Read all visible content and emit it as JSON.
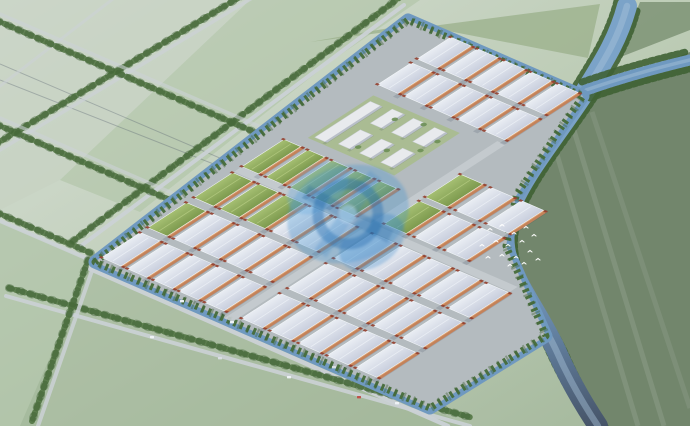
{
  "scene": {
    "canvas": {
      "width": 690,
      "height": 426
    },
    "palette": {
      "haze_white": "#f4f8fa",
      "field_pale": "#ccd6c8",
      "field_mid": "#a8bca0",
      "field_dark": "#72866c",
      "water": "#6f99c0",
      "water_dark": "#465468",
      "trees": "#4f7340",
      "trees_dark": "#3f6234",
      "road": "#ccd2d6",
      "park_ground": "#b4bbbf",
      "roof_light": "#d7dbe7",
      "roof_green": "#8fae5a",
      "wall_orange": "#c4825a",
      "wall_highlight": "#dfa777",
      "tower_red": "#94402f",
      "campus_white": "#e8eaed",
      "lawn": "#a9bd8e",
      "watermark_blue": "#3b8fd0",
      "watermark_deep": "#1d6cb0",
      "watermark_light": "#bfe0f5"
    },
    "fields": [
      {
        "name": "field-upper-left-a",
        "pts": [
          [
            0,
            0
          ],
          [
            250,
            0
          ],
          [
            60,
            180
          ],
          [
            0,
            210
          ]
        ],
        "fill": "#c6d2c2",
        "op": 0.7
      },
      {
        "name": "field-upper-left-b",
        "pts": [
          [
            250,
            0
          ],
          [
            420,
            0
          ],
          [
            330,
            62
          ],
          [
            140,
            212
          ],
          [
            60,
            180
          ]
        ],
        "fill": "#b0c4a8",
        "op": 0.65
      },
      {
        "name": "field-upper-mid",
        "pts": [
          [
            310,
            42
          ],
          [
            600,
            4
          ],
          [
            588,
            58
          ],
          [
            412,
            24
          ]
        ],
        "fill": "#9cb28d",
        "op": 0.8
      },
      {
        "name": "field-top-right",
        "pts": [
          [
            618,
            58
          ],
          [
            690,
            30
          ],
          [
            690,
            2
          ],
          [
            640,
            2
          ]
        ],
        "fill": "#7e9376",
        "op": 0.85
      },
      {
        "name": "field-right-dark",
        "pts": [
          [
            598,
            88
          ],
          [
            690,
            52
          ],
          [
            690,
            426
          ],
          [
            598,
            426
          ],
          [
            562,
            352
          ],
          [
            516,
            260
          ],
          [
            512,
            212
          ],
          [
            542,
            156
          ]
        ],
        "fill": "#72866c",
        "op": 1
      },
      {
        "name": "field-left-low",
        "pts": [
          [
            0,
            222
          ],
          [
            92,
            262
          ],
          [
            40,
            426
          ],
          [
            0,
            426
          ]
        ],
        "fill": "#aabfa2",
        "op": 0.6
      },
      {
        "name": "field-bottom",
        "pts": [
          [
            92,
            262
          ],
          [
            432,
            410
          ],
          [
            470,
            426
          ],
          [
            20,
            426
          ],
          [
            40,
            380
          ]
        ],
        "fill": "#9db394",
        "op": 0.55
      }
    ],
    "field_streaks": [
      {
        "from": [
          552,
          138
        ],
        "to": [
          638,
          426
        ],
        "op": 0.1
      },
      {
        "from": [
          572,
          124
        ],
        "to": [
          664,
          426
        ],
        "op": 0.1
      },
      {
        "from": [
          592,
          112
        ],
        "to": [
          690,
          408
        ],
        "op": 0.08
      }
    ],
    "powerlines": [
      {
        "from": [
          0,
          64
        ],
        "to": [
          332,
          206
        ]
      },
      {
        "from": [
          0,
          80
        ],
        "to": [
          338,
          213
        ]
      }
    ],
    "roads": [
      {
        "name": "road-nw-boundary",
        "from": [
          78,
          248
        ],
        "to": [
          404,
          5
        ],
        "w": 4,
        "op": 0.95,
        "trees": [
          [
            -5,
            -7
          ]
        ]
      },
      {
        "name": "road-sw-upper",
        "from": [
          0,
          221
        ],
        "to": [
          95,
          262
        ],
        "w": 4,
        "op": 0.9,
        "trees": [
          [
            -2,
            -8
          ]
        ]
      },
      {
        "name": "road-se-boundary",
        "from": [
          88,
          268
        ],
        "to": [
          448,
          426
        ],
        "w": 4.5,
        "op": 0.95,
        "trees": []
      },
      {
        "name": "road-south-parallel",
        "from": [
          6,
          296
        ],
        "to": [
          470,
          426
        ],
        "w": 4,
        "op": 0.9,
        "trees": [
          [
            3,
            -8
          ]
        ]
      },
      {
        "name": "road-west-exit",
        "from": [
          95,
          262
        ],
        "to": [
          38,
          426
        ],
        "w": 4,
        "op": 0.85,
        "trees": [
          [
            -7,
            -2
          ]
        ]
      },
      {
        "name": "road-grid-a",
        "from": [
          0,
          150
        ],
        "to": [
          262,
          -8
        ],
        "w": 3.5,
        "op": 0.75,
        "trees": [
          [
            -4,
            -6
          ]
        ]
      },
      {
        "name": "road-grid-b",
        "from": [
          0,
          86
        ],
        "to": [
          122,
          -8
        ],
        "w": 3,
        "op": 0.6,
        "trees": []
      },
      {
        "name": "road-grid-c",
        "from": [
          0,
          14
        ],
        "to": [
          330,
          157
        ],
        "w": 3.5,
        "op": 0.6,
        "trees": [
          [
            -2,
            7
          ]
        ]
      },
      {
        "name": "road-grid-d",
        "from": [
          0,
          118
        ],
        "to": [
          218,
          213
        ],
        "w": 3.5,
        "op": 0.6,
        "trees": [
          [
            -2,
            7
          ]
        ]
      }
    ],
    "rivers": [
      {
        "name": "main-river",
        "d": "M627,6 C618,40 602,64 586,90 C566,122 528,168 513,202 C503,224 501,246 511,268 C524,296 543,322 556,350 C570,382 586,408 598,426",
        "w": 20,
        "grad": true,
        "trees": [
          [
            -10,
            -5
          ],
          [
            10,
            5
          ]
        ],
        "hl": true
      },
      {
        "name": "river-branch",
        "d": "M586,90 C615,80 648,70 690,60",
        "w": 11,
        "grad": false,
        "trees": [
          [
            -4,
            -8
          ],
          [
            4,
            8
          ]
        ],
        "hl": true
      }
    ],
    "park": {
      "outline": "95,262 408,20 583,96 558,132 516,196 506,246 530,300 546,336 430,408",
      "matrix": [
        0.84,
        -0.545,
        0.92,
        0.4,
        95,
        262
      ],
      "inner_roads": [
        {
          "from": [
            0,
            145
          ],
          "to": [
            325,
            145
          ]
        },
        {
          "from": [
            170,
            0
          ],
          "to": [
            170,
            300
          ]
        }
      ],
      "lawn": {
        "x": 238,
        "y": 14,
        "w": 78,
        "h": 94
      },
      "blocks": [
        {
          "name": "west-warehouse-grid",
          "u0": 8,
          "v0": 0,
          "nu": 3,
          "nv": 5,
          "bl": 46,
          "bw": 21,
          "gu": 9,
          "gv": 7,
          "green": [
            [
              2,
              0
            ],
            [
              2,
              1
            ],
            [
              2,
              2
            ],
            [
              1,
              0
            ]
          ]
        },
        {
          "name": "green-roof-strip",
          "u0": 175,
          "v0": 0,
          "nu": 1,
          "nv": 5,
          "bl": 50,
          "bw": 18,
          "gu": 0,
          "gv": 8,
          "green": [
            [
              0,
              0
            ],
            [
              0,
              1
            ],
            [
              0,
              2
            ],
            [
              0,
              3
            ],
            [
              0,
              4
            ]
          ]
        },
        {
          "name": "northeast-warehouse-grid",
          "u0": 330,
          "v0": 6,
          "nu": 2,
          "nv": 5,
          "bl": 40,
          "bw": 22,
          "gu": 7,
          "gv": 7,
          "green": []
        },
        {
          "name": "east-warehouse-grid",
          "u0": 180,
          "v0": 150,
          "nu": 2,
          "nv": 3,
          "bl": 42,
          "bw": 24,
          "gu": 7,
          "gv": 9,
          "green": [
            [
              0,
              0
            ],
            [
              1,
              0
            ]
          ]
        },
        {
          "name": "south-warehouse-grid",
          "u0": 8,
          "v0": 152,
          "nu": 3,
          "nv": 5,
          "bl": 46,
          "bw": 23,
          "gu": 9,
          "gv": 8,
          "green": []
        }
      ],
      "campus": {
        "bar": {
          "x": 242,
          "y": 18,
          "w": 66,
          "h": 11
        },
        "slab_cols": [
          246,
          284
        ],
        "slab_rows": [
          40,
          63,
          86
        ],
        "slab_w": 26,
        "slab_h": 12,
        "trees": [
          [
            252,
            56
          ],
          [
            262,
            78
          ],
          [
            300,
            52
          ],
          [
            308,
            76
          ],
          [
            278,
            100
          ],
          [
            296,
            102
          ]
        ]
      }
    },
    "watermark": {
      "cx": 348,
      "cy": 214,
      "opacity": 0.32
    },
    "cars": {
      "positions": [
        [
          150,
          336
        ],
        [
          218,
          357
        ],
        [
          287,
          376
        ],
        [
          357,
          396
        ],
        [
          230,
          321
        ],
        [
          332,
          366
        ],
        [
          180,
          300
        ],
        [
          395,
          402
        ]
      ],
      "colors": [
        "#eef2f5",
        "#d9dee3",
        "#eef2f5",
        "#c0524a",
        "#eef2f5",
        "#d9dee3",
        "#eef2f5",
        "#eef2f5"
      ]
    },
    "birds": {
      "center": [
        512,
        244
      ],
      "offsets": [
        [
          -22,
          -14
        ],
        [
          -10,
          -18
        ],
        [
          2,
          -10
        ],
        [
          14,
          -16
        ],
        [
          -30,
          2
        ],
        [
          -16,
          -2
        ],
        [
          -4,
          2
        ],
        [
          10,
          -2
        ],
        [
          22,
          -8
        ],
        [
          -24,
          14
        ],
        [
          -10,
          12
        ],
        [
          4,
          14
        ],
        [
          18,
          8
        ],
        [
          -2,
          22
        ],
        [
          12,
          20
        ],
        [
          26,
          16
        ]
      ]
    },
    "mist": {
      "clouds": [
        [
          40,
          30,
          260,
          140,
          0.95
        ],
        [
          170,
          95,
          200,
          110,
          0.6
        ],
        [
          15,
          195,
          170,
          110,
          0.7
        ],
        [
          120,
          60,
          190,
          100,
          0.7
        ],
        [
          420,
          8,
          150,
          55,
          0.5
        ],
        [
          110,
          395,
          200,
          95,
          0.75
        ],
        [
          305,
          422,
          190,
          80,
          0.55
        ],
        [
          50,
          320,
          150,
          90,
          0.6
        ],
        [
          640,
          16,
          130,
          60,
          0.5
        ]
      ],
      "dark_corner": [
        700,
        430,
        240,
        160
      ]
    }
  }
}
